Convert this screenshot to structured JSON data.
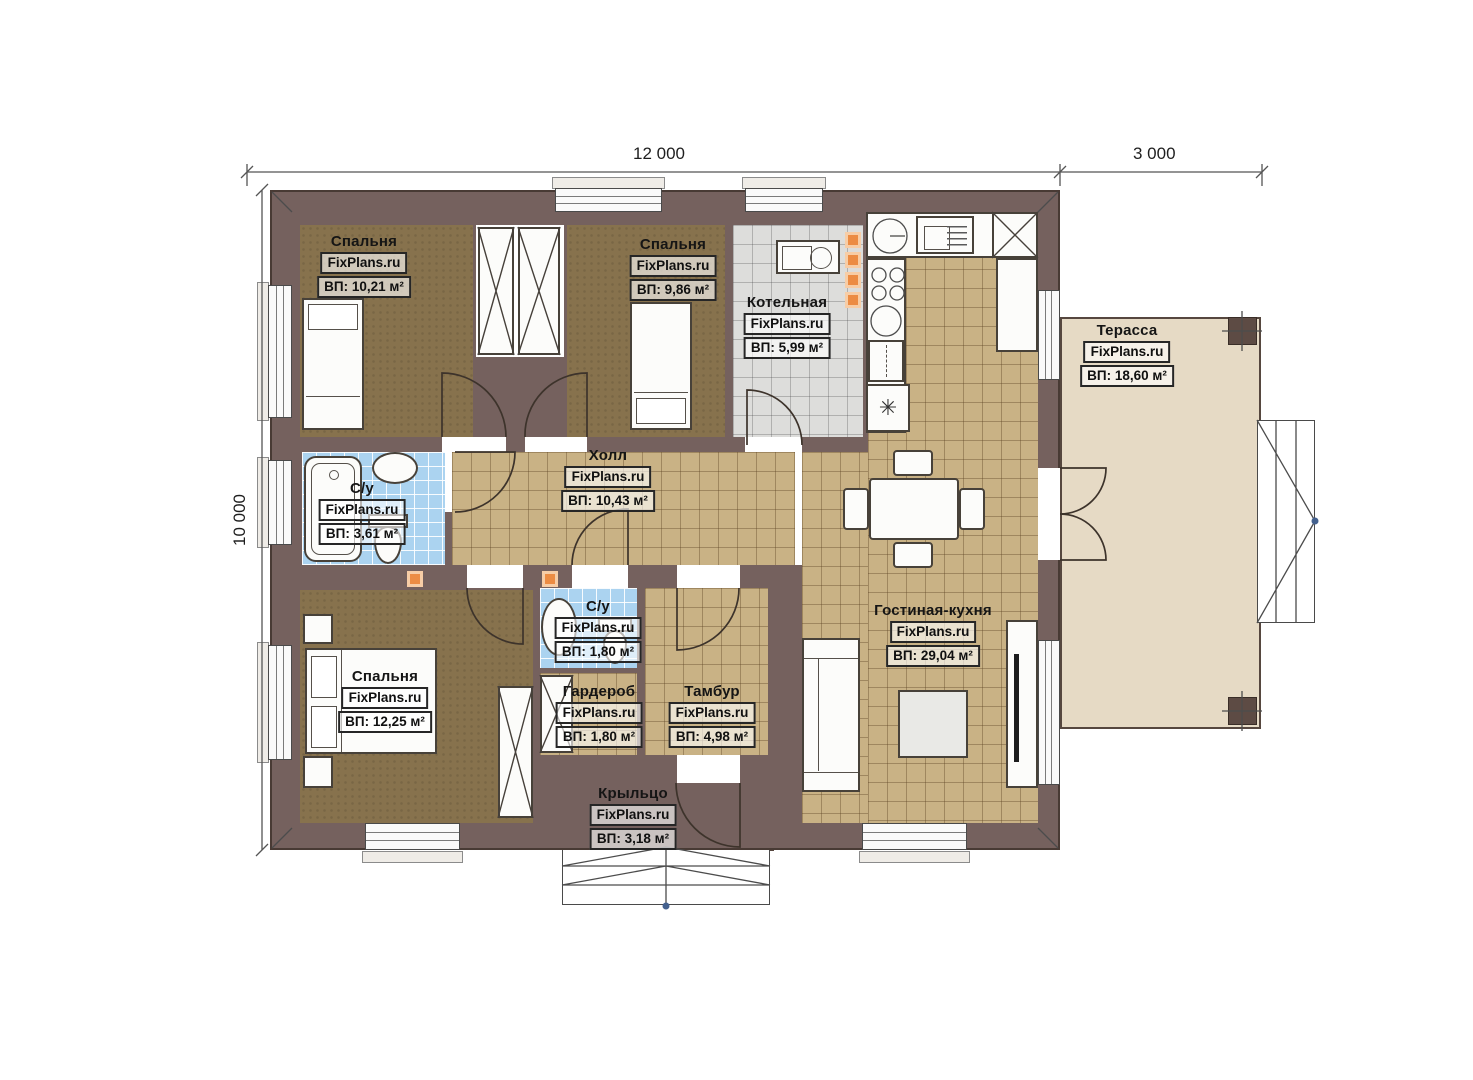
{
  "brand": "FixPlans.ru",
  "dimensions": {
    "width_main": "12 000",
    "width_terrace": "3 000",
    "height": "10 000"
  },
  "rooms": {
    "bedroom1": {
      "name": "Спальня",
      "area": "ВП: 10,21 м²"
    },
    "bedroom2": {
      "name": "Спальня",
      "area": "ВП: 9,86 м²"
    },
    "boiler": {
      "name": "Котельная",
      "area": "ВП: 5,99 м²"
    },
    "hall": {
      "name": "Холл",
      "area": "ВП: 10,43 м²"
    },
    "bath_main": {
      "name": "С/у",
      "area": "ВП: 3,61 м²"
    },
    "bedroom3": {
      "name": "Спальня",
      "area": "ВП: 12,25 м²"
    },
    "bath_small": {
      "name": "С/у",
      "area": "ВП: 1,80 м²"
    },
    "wardrobe": {
      "name": "Гардероб",
      "area": "ВП: 1,80 м²"
    },
    "vestibule": {
      "name": "Тамбур",
      "area": "ВП: 4,98 м²"
    },
    "living_kitchen": {
      "name": "Гостиная-кухня",
      "area": "ВП: 29,04 м²"
    },
    "terrace": {
      "name": "Терасса",
      "area": "ВП: 18,60 м²"
    },
    "porch": {
      "name": "Крыльцо",
      "area": "ВП: 3,18 м²"
    }
  },
  "colors": {
    "wall": "#75615e",
    "tile_tan": "#c9b285",
    "tile_gray": "#dddddb",
    "tile_blue": "#abd3f0",
    "floor_wood": "#87724d",
    "outdoor_floor": "#e6dac5",
    "accent_orange": "#ec8c44"
  }
}
